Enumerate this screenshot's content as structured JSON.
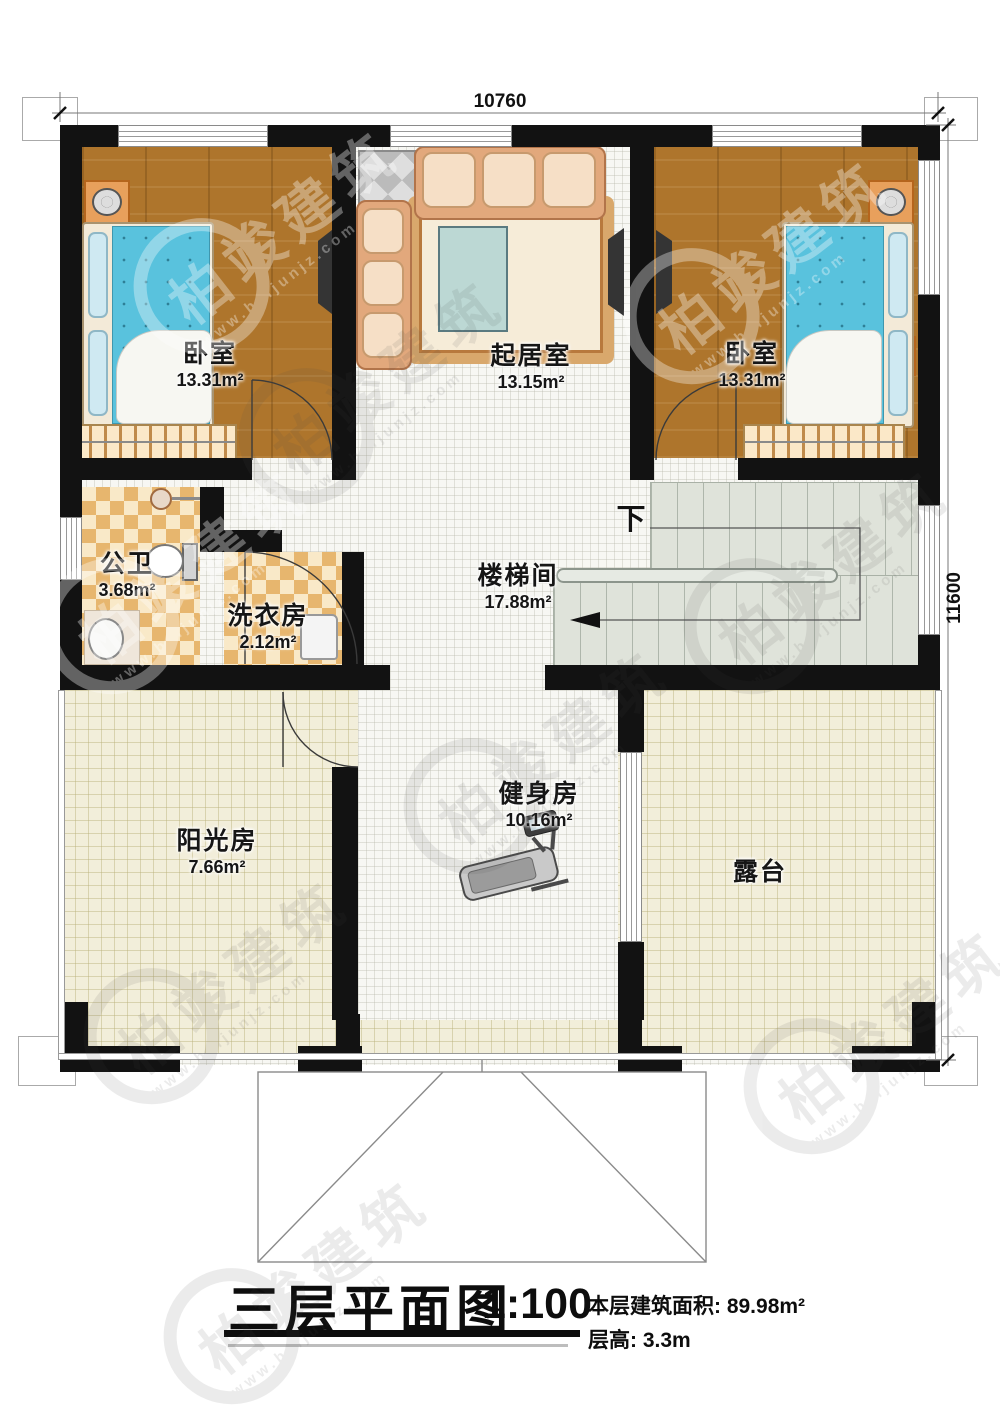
{
  "plan": {
    "dimensions": {
      "top": "10760",
      "right": "11600"
    },
    "stair_direction_label": "下",
    "rooms": [
      {
        "id": "bedroom-left",
        "name": "卧室",
        "area": "13.31m²"
      },
      {
        "id": "living-room",
        "name": "起居室",
        "area": "13.15m²"
      },
      {
        "id": "bedroom-right",
        "name": "卧室",
        "area": "13.31m²"
      },
      {
        "id": "bathroom",
        "name": "公卫",
        "area": "3.68m²"
      },
      {
        "id": "laundry",
        "name": "洗衣房",
        "area": "2.12m²"
      },
      {
        "id": "stairwell",
        "name": "楼梯间",
        "area": "17.88m²"
      },
      {
        "id": "gym",
        "name": "健身房",
        "area": "10.16m²"
      },
      {
        "id": "sunroom",
        "name": "阳光房",
        "area": "7.66m²"
      },
      {
        "id": "terrace",
        "name": "露台",
        "area": ""
      }
    ]
  },
  "title_block": {
    "title": "三层平面图",
    "scale": "1:100",
    "area_line": "本层建筑面积: 89.98m²",
    "height_line": "层高: 3.3m"
  },
  "watermark": {
    "brand": "柏竣建筑",
    "url": "www.baijunjz.com"
  },
  "colors": {
    "wall": "#121212",
    "wood_floor": "#ae752c",
    "tile_dark": "#e7b66e",
    "tile_light": "#f9e9c8",
    "stair_floor": "#dfe3da",
    "terrace_floor": "#f2eeda",
    "bed_mattress": "#59c2dd",
    "sofa": "#e2a87c"
  }
}
